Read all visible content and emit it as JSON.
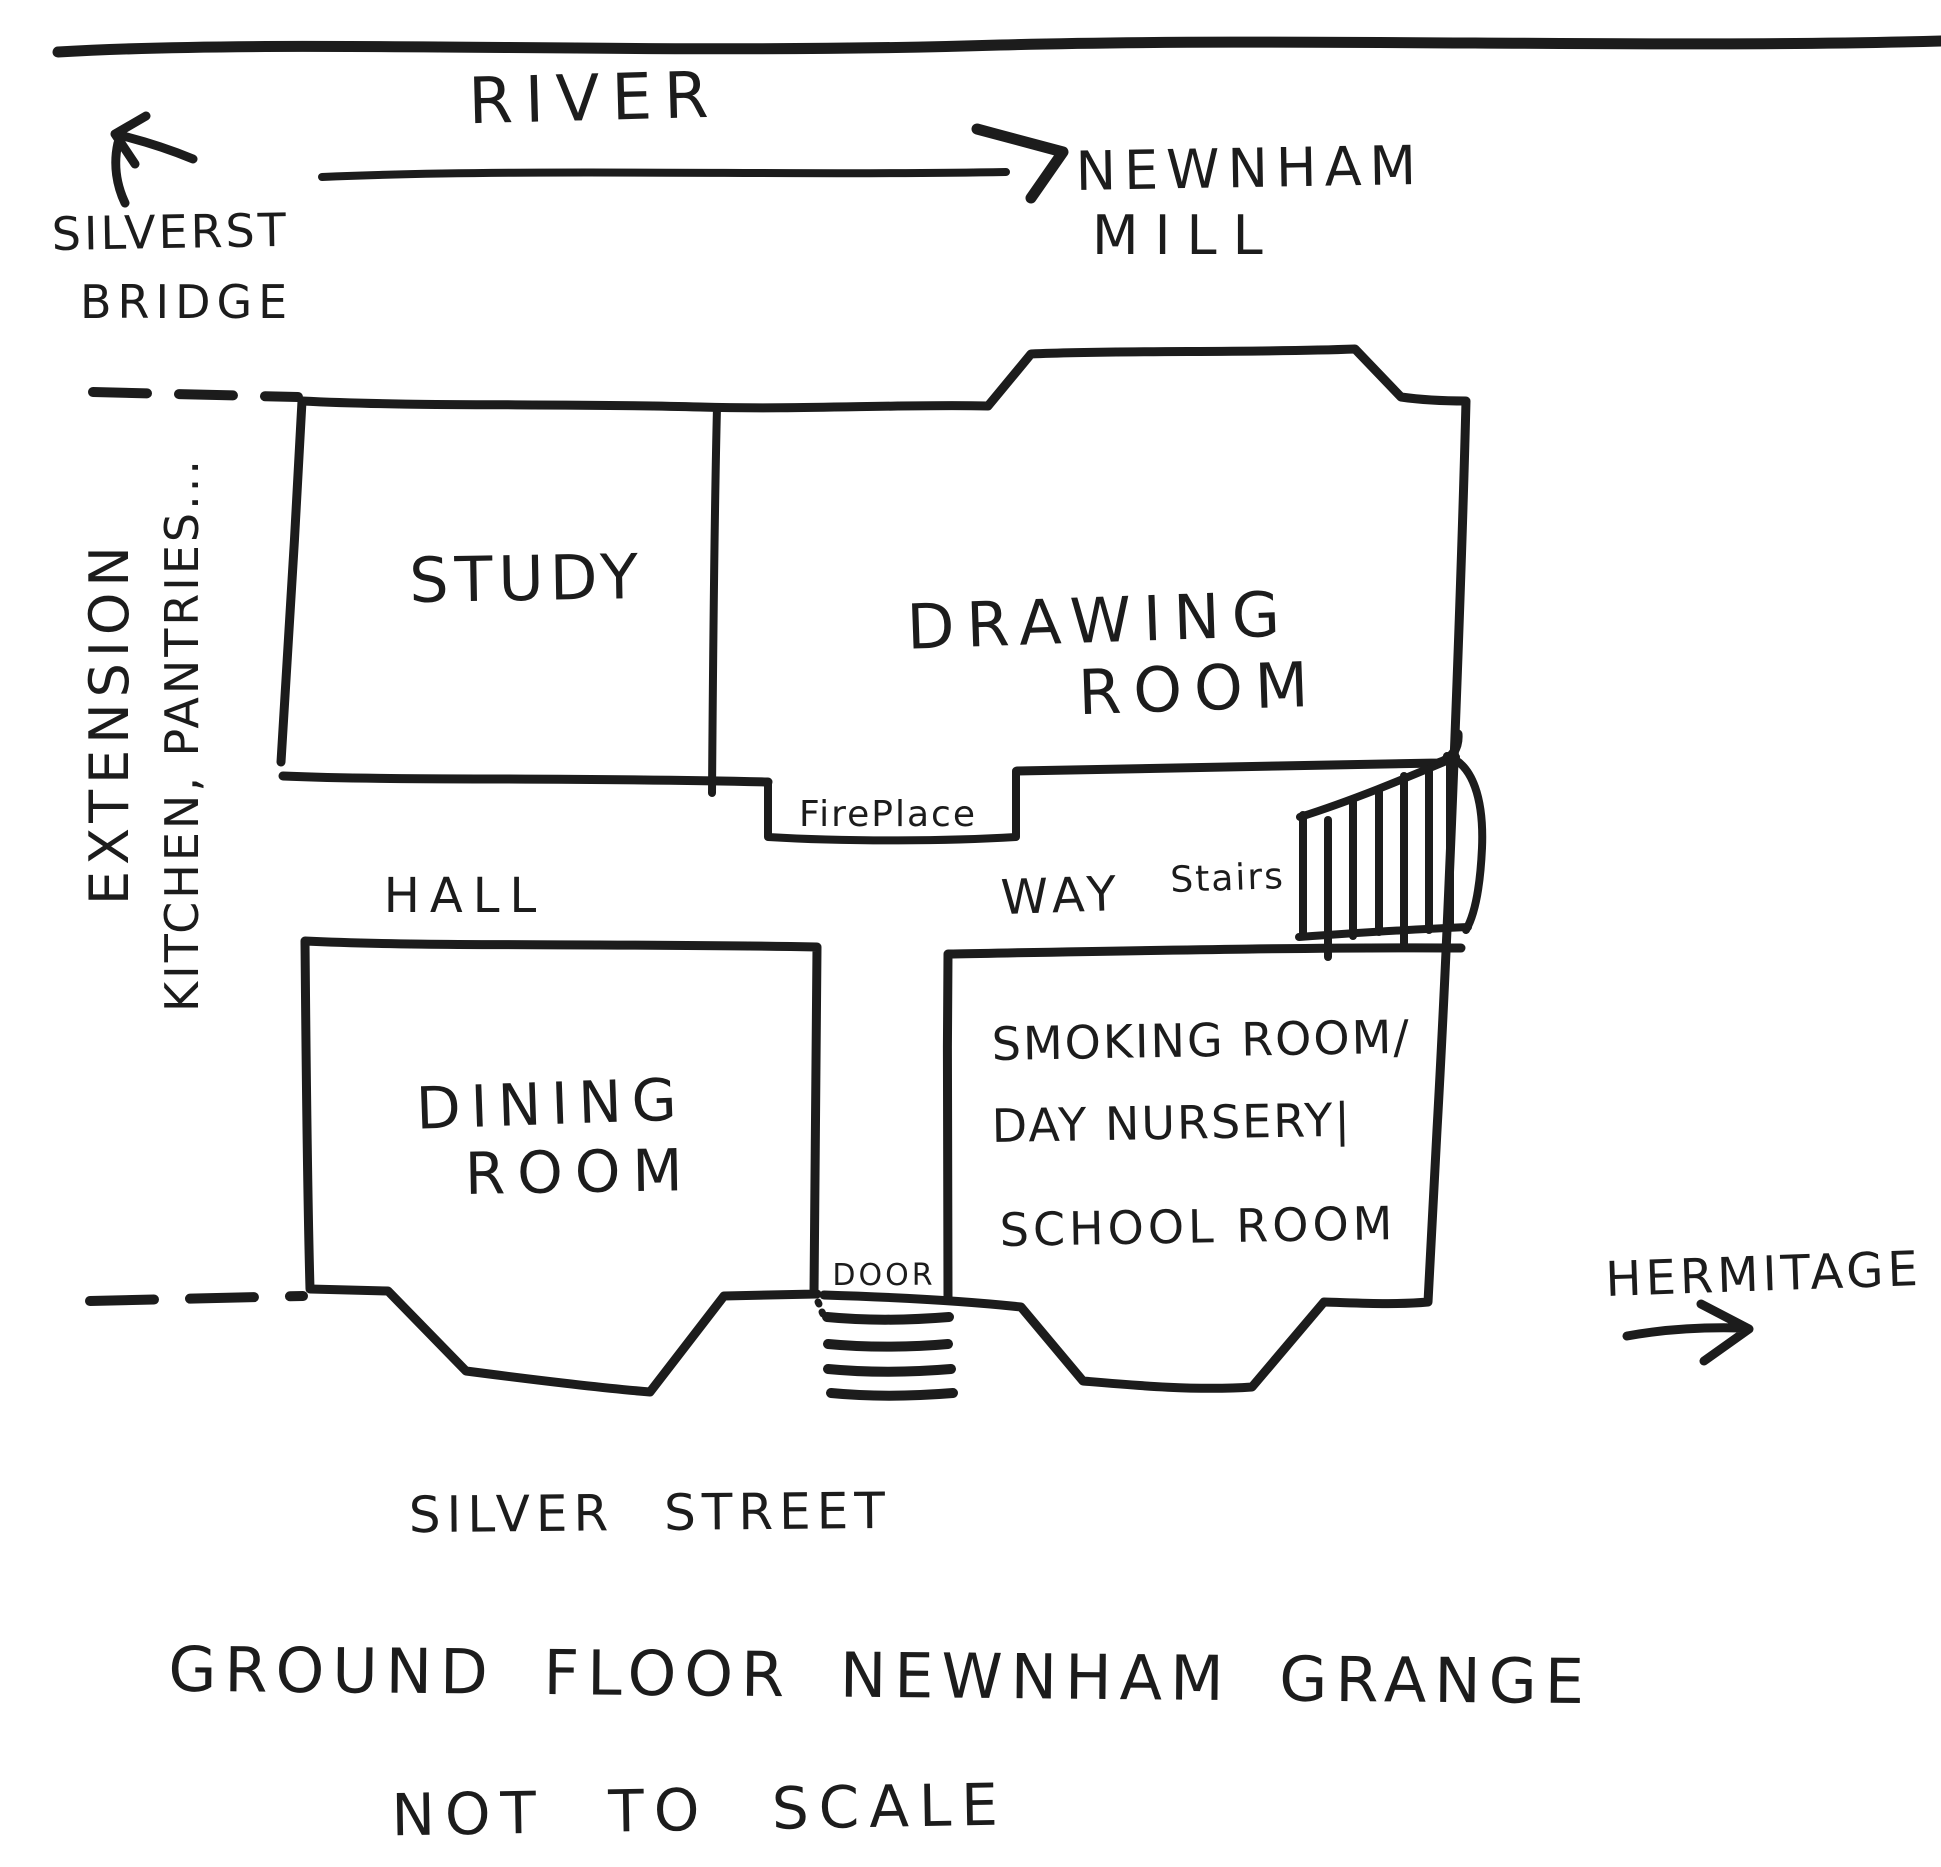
{
  "title": "Ground Floor Newnham Grange sketch plan",
  "colors": {
    "ink": "#1c1c1c",
    "paper": "#ffffff"
  },
  "labels": {
    "river": "RIVER",
    "silverst": "SILVERST",
    "bridge": "BRIDGE",
    "newnham": "NEWNHAM",
    "mill": "MILL",
    "extension": "EXTENSION",
    "kitchen_pantries": "KITCHEN, PANTRIES...",
    "study": "STUDY",
    "drawing_room_line1": "DRAWING",
    "drawing_room_line2": "ROOM",
    "fireplace": "FirePlace",
    "hall": "HALL",
    "way": "WAY",
    "stairs": "Stairs",
    "dining_room_line1": "DINING",
    "dining_room_line2": "ROOM",
    "smoking_room_line1": "SMOKING ROOM/",
    "smoking_room_line2": "DAY NURSERY|",
    "smoking_room_line3": "SCHOOL ROOM",
    "door": "DOOR",
    "hermitage": "HERMITAGE",
    "silver_street": "SILVER STREET",
    "plan_title": "GROUND FLOOR NEWNHAM GRANGE",
    "scale_note": "NOT TO SCALE"
  }
}
